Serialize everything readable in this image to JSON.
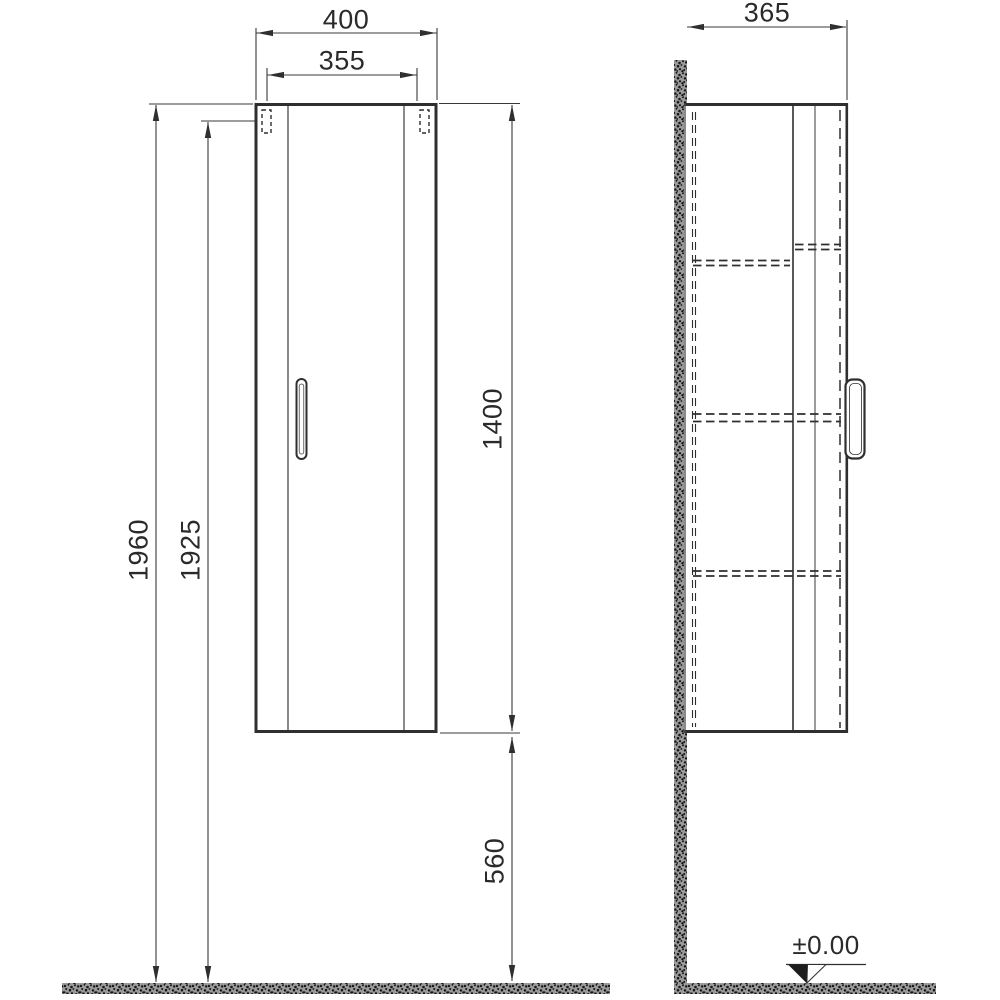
{
  "drawing": {
    "front_view": {
      "overall_width": "400",
      "door_width": "355",
      "overall_height": "1960",
      "door_height": "1925",
      "cabinet_height": "1400",
      "floor_clearance": "560"
    },
    "side_view": {
      "depth": "365",
      "floor_level": "±0.00"
    },
    "colors": {
      "line": "#2f2f2f",
      "dimension_line": "#3a3a3a",
      "text": "#2a2a2a",
      "hatch": "#9a9a9a",
      "background": "#ffffff"
    }
  }
}
